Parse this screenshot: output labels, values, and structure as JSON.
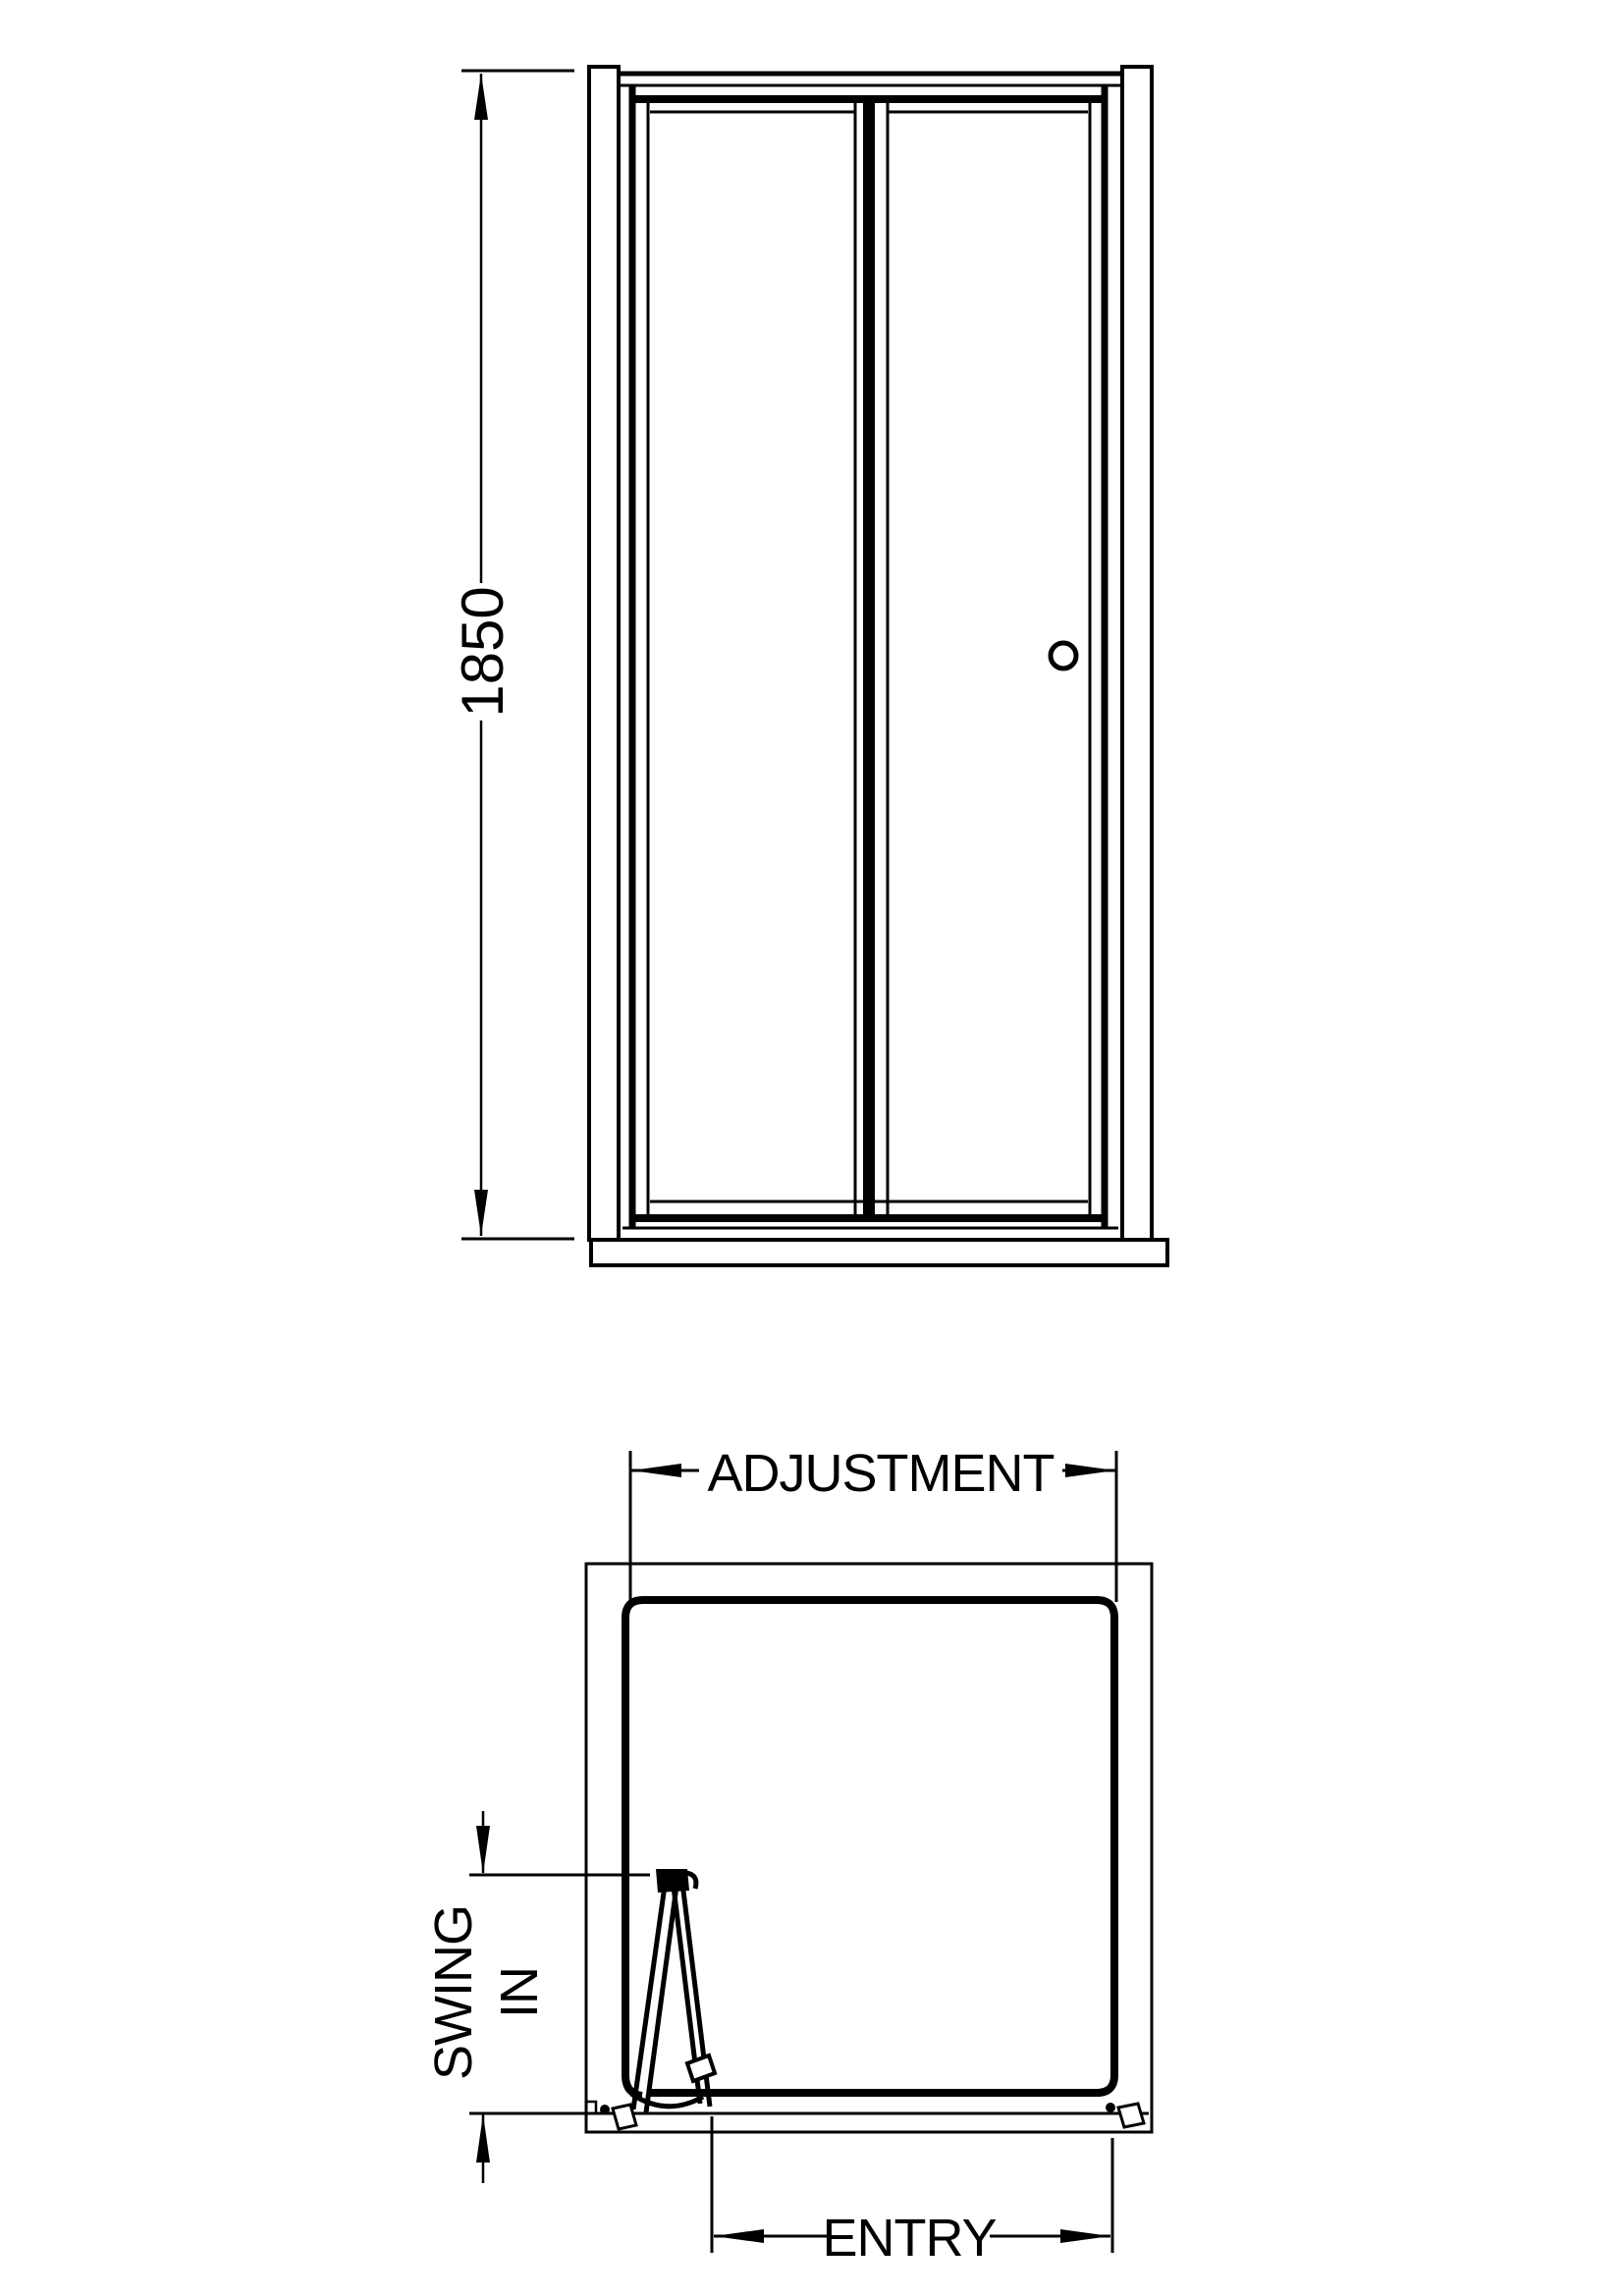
{
  "colors": {
    "line": "#000000",
    "background": "#ffffff"
  },
  "elevation": {
    "height_label": "1850"
  },
  "plan": {
    "adjustment_label": "ADJUSTMENT",
    "swing_label_line1": "SWING",
    "swing_label_line2": "IN",
    "entry_label": "ENTRY"
  }
}
